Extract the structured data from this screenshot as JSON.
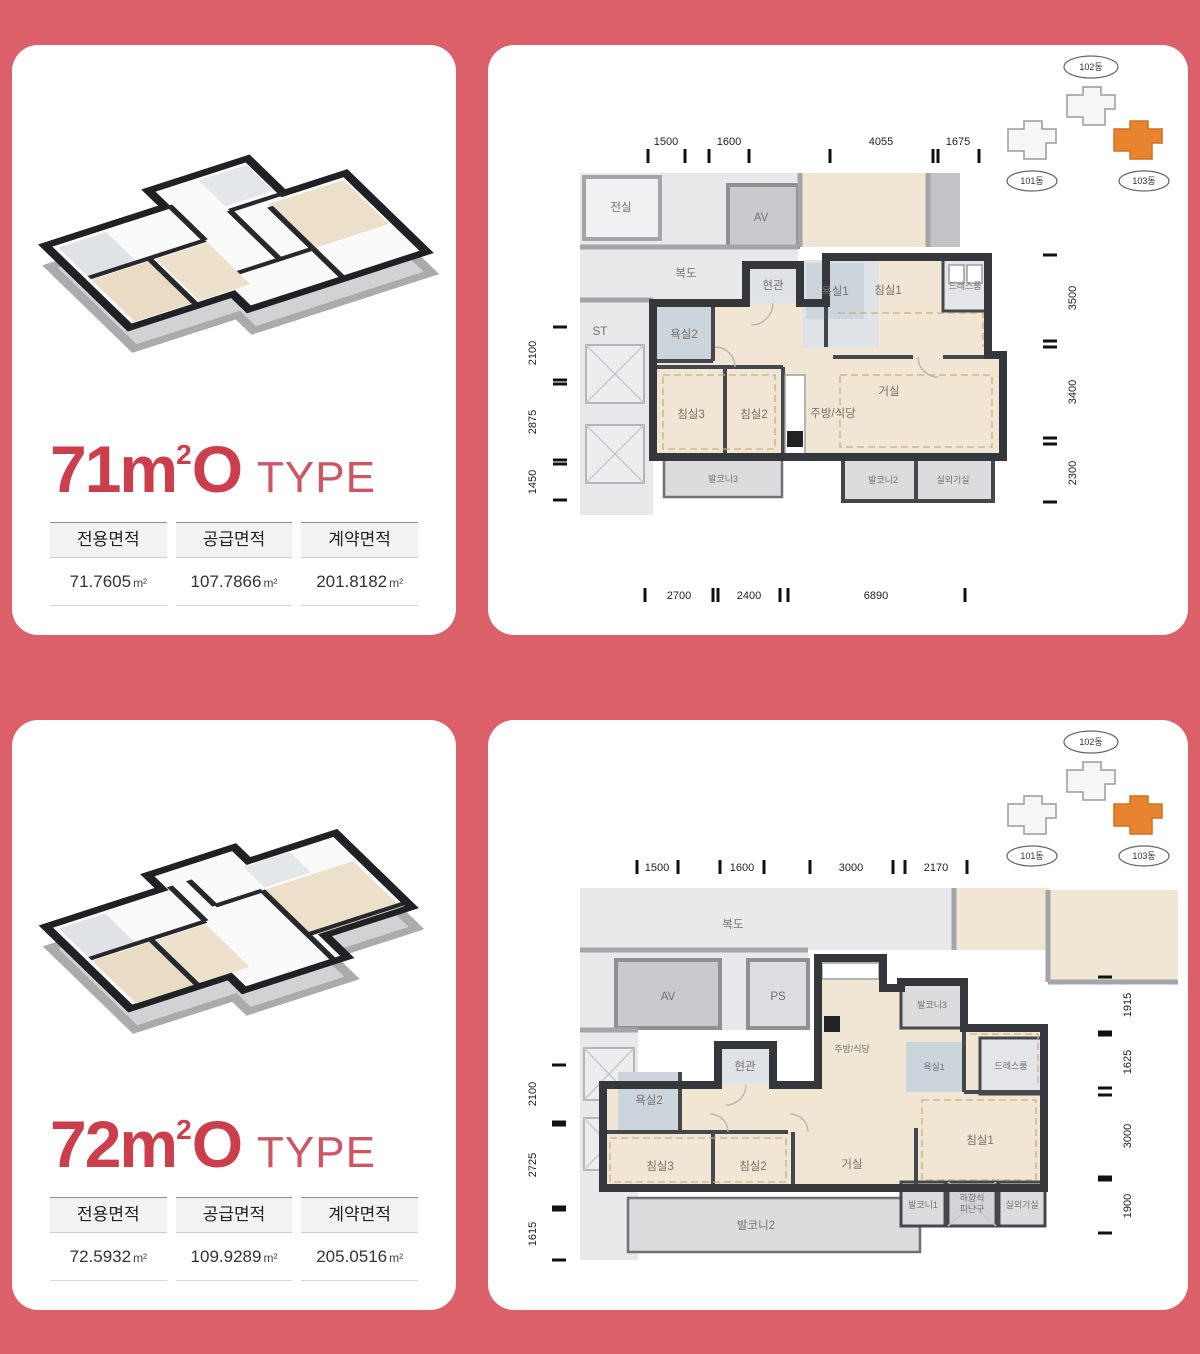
{
  "type71_card": {
    "title": {
      "num": "71",
      "unit": "m",
      "sup": "2",
      "o": "O",
      "type": "TYPE"
    },
    "table": {
      "headers": [
        "전용면적",
        "공급면적",
        "계약면적"
      ],
      "values": [
        "71.7605",
        "107.7866",
        "201.8182"
      ],
      "unit": "m²"
    }
  },
  "type72_card": {
    "title": {
      "num": "72",
      "unit": "m",
      "sup": "2",
      "o": "O",
      "type": "TYPE"
    },
    "table": {
      "headers": [
        "전용면적",
        "공급면적",
        "계약면적"
      ],
      "values": [
        "72.5932",
        "109.9289",
        "205.0516"
      ],
      "unit": "m²"
    }
  },
  "siteplan": {
    "b101": "101동",
    "b102": "102동",
    "b103": "103동"
  },
  "plan71": {
    "dims": {
      "top": [
        "1500",
        "1600",
        "4055",
        "1675"
      ],
      "left": [
        "2100",
        "2875",
        "1450"
      ],
      "right": [
        "3500",
        "3400",
        "2300"
      ],
      "bottom": [
        "2700",
        "2400",
        "6890"
      ]
    },
    "rooms": {
      "jeonsil": "전실",
      "bokdo": "복도",
      "av": "AV",
      "st": "ST",
      "bath2": "욕실2",
      "entry": "현관",
      "bath1": "욕실1",
      "bed1": "침실1",
      "dress": "드레스룸",
      "bed3": "침실3",
      "bed2": "침실2",
      "kitchen": "주방/식당",
      "living": "거실",
      "balcony3": "발코니3",
      "balcony2": "발코니2",
      "outdoor_unit": "실외기실"
    }
  },
  "plan72": {
    "dims": {
      "top": [
        "1500",
        "1600",
        "3000",
        "2170"
      ],
      "left": [
        "2100",
        "2725",
        "1615"
      ],
      "right": [
        "1915",
        "1625",
        "3000",
        "1900"
      ]
    },
    "rooms": {
      "bokdo": "복도",
      "av": "AV",
      "ps": "PS",
      "entry": "현관",
      "kitchen": "주방/식당",
      "balcony3": "발코니3",
      "bath1": "욕실1",
      "dress": "드레스룸",
      "bath2": "욕실2",
      "bed3": "침실3",
      "bed2": "침실2",
      "living": "거실",
      "bed1": "침실1",
      "balcony1": "발코니1",
      "hatch1": "하향식",
      "hatch2": "피난구",
      "outdoor_unit": "실외기실",
      "balcony2": "발코니2"
    }
  }
}
